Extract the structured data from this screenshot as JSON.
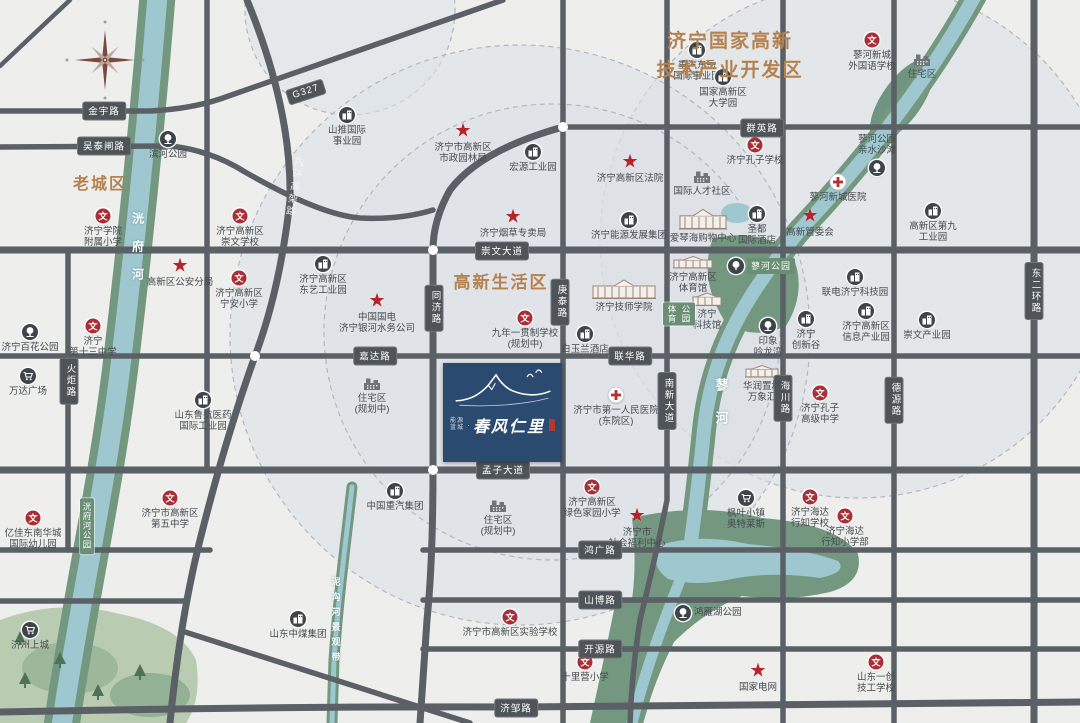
{
  "map": {
    "title": "济宁国家高新\n技术产业开发区",
    "area_labels": [
      {
        "text": "老城区",
        "x": 100,
        "y": 170,
        "size": 16
      },
      {
        "text": "高新生活区",
        "x": 501,
        "y": 268,
        "size": 17
      }
    ],
    "road_badges": [
      {
        "text": "金宇路",
        "x": 104,
        "y": 111,
        "orient": "h"
      },
      {
        "text": "吴泰闸路",
        "x": 104,
        "y": 146,
        "orient": "h"
      },
      {
        "text": "崇文大道",
        "x": 502,
        "y": 251,
        "orient": "h"
      },
      {
        "text": "群英路",
        "x": 762,
        "y": 128,
        "orient": "h"
      },
      {
        "text": "嘉达路",
        "x": 375,
        "y": 356,
        "orient": "h"
      },
      {
        "text": "联华路",
        "x": 630,
        "y": 356,
        "orient": "h"
      },
      {
        "text": "孟子大道",
        "x": 503,
        "y": 470,
        "orient": "h"
      },
      {
        "text": "鸿广路",
        "x": 600,
        "y": 550,
        "orient": "h"
      },
      {
        "text": "山博路",
        "x": 600,
        "y": 600,
        "orient": "h"
      },
      {
        "text": "开源路",
        "x": 600,
        "y": 649,
        "orient": "h"
      },
      {
        "text": "济邹路",
        "x": 516,
        "y": 708,
        "orient": "h"
      },
      {
        "text": "G327",
        "x": 306,
        "y": 92,
        "orient": "h",
        "rot": -18
      },
      {
        "text": "同济路",
        "x": 434,
        "y": 308,
        "orient": "v"
      },
      {
        "text": "庚泰路",
        "x": 560,
        "y": 302,
        "orient": "v"
      },
      {
        "text": "南新大道",
        "x": 667,
        "y": 401,
        "orient": "v"
      },
      {
        "text": "海川路",
        "x": 783,
        "y": 398,
        "orient": "v"
      },
      {
        "text": "德源路",
        "x": 894,
        "y": 400,
        "orient": "v"
      },
      {
        "text": "东二环路",
        "x": 1034,
        "y": 291,
        "orient": "v"
      },
      {
        "text": "火炬路",
        "x": 69,
        "y": 381,
        "orient": "v"
      }
    ],
    "road_names_on_road": [
      {
        "text": "内环高架路",
        "x": 293,
        "y": 156,
        "rot": 10
      }
    ],
    "green_badges": [
      {
        "kind": "cols",
        "cols": [
          "体育",
          "公园"
        ],
        "x": 679,
        "y": 314
      },
      {
        "kind": "pill",
        "text": "蓼河公园",
        "x": 728,
        "y": 266
      },
      {
        "kind": "vcol",
        "text": "洸府河公园",
        "x": 87,
        "y": 526
      }
    ],
    "river_labels": [
      {
        "text": "洸府河",
        "x": 138,
        "y": 212,
        "size": 12,
        "ls": 16
      },
      {
        "text": "蓼河",
        "x": 721,
        "y": 378,
        "size": 13,
        "ls": 20
      },
      {
        "text": "泥沟河景观带",
        "x": 336,
        "y": 577,
        "size": 9,
        "ls": 6
      }
    ],
    "markers": [
      {
        "type": "wen",
        "x": 103,
        "y": 216,
        "label": "济宁学院\n附属小学"
      },
      {
        "type": "wen",
        "x": 240,
        "y": 216,
        "label": "济宁高新区\n崇文学校"
      },
      {
        "type": "wen",
        "x": 239,
        "y": 278,
        "label": "济宁高新区\n宁安小学"
      },
      {
        "type": "wen",
        "x": 93,
        "y": 326,
        "label": "济宁\n第十三中学"
      },
      {
        "type": "wen",
        "x": 33,
        "y": 518,
        "label": "亿佳东南华城\n国际幼儿园"
      },
      {
        "type": "wen",
        "x": 170,
        "y": 498,
        "label": "济宁市高新区\n第五中学"
      },
      {
        "type": "wen",
        "x": 525,
        "y": 318,
        "label": "九年一贯制学校\n(规划中)"
      },
      {
        "type": "wen",
        "x": 872,
        "y": 40,
        "label": "蓼河新城\n外国语学校"
      },
      {
        "type": "wen",
        "x": 755,
        "y": 145,
        "label": "济宁孔子学校"
      },
      {
        "type": "wen",
        "x": 820,
        "y": 393,
        "label": "济宁孔子\n高级中学"
      },
      {
        "type": "wen",
        "x": 592,
        "y": 487,
        "label": "济宁高新区\n绿色家园小学"
      },
      {
        "type": "wen",
        "x": 510,
        "y": 617,
        "label": "济宁市高新区实验学校"
      },
      {
        "type": "wen",
        "x": 585,
        "y": 662,
        "label": "十里营小学"
      },
      {
        "type": "wen",
        "x": 810,
        "y": 497,
        "label": "济宁海达\n行知学校"
      },
      {
        "type": "wen",
        "x": 845,
        "y": 516,
        "label": "济宁海达\n行知小学部"
      },
      {
        "type": "wen",
        "x": 876,
        "y": 662,
        "label": "山东一创\n技工学校"
      },
      {
        "type": "star",
        "x": 463,
        "y": 131,
        "label": "济宁市高新区\n市政园林局"
      },
      {
        "type": "star",
        "x": 630,
        "y": 162,
        "label": "济宁高新区法院"
      },
      {
        "type": "star",
        "x": 513,
        "y": 217,
        "label": "济宁烟草专卖局"
      },
      {
        "type": "star",
        "x": 180,
        "y": 266,
        "label": "高新区公安分局"
      },
      {
        "type": "star",
        "x": 377,
        "y": 301,
        "label": "中国国电\n济宁银河水务公司"
      },
      {
        "type": "star",
        "x": 810,
        "y": 216,
        "label": "高新管委会"
      },
      {
        "type": "star",
        "x": 637,
        "y": 516,
        "label": "济宁市\n社会福利中心"
      },
      {
        "type": "star",
        "x": 758,
        "y": 671,
        "label": "国家电网"
      },
      {
        "type": "building",
        "x": 347,
        "y": 115,
        "label": "山推国际\n事业园"
      },
      {
        "type": "building",
        "x": 697,
        "y": 50,
        "label": "重汽东岳\n国际事业园"
      },
      {
        "type": "building",
        "x": 723,
        "y": 77,
        "label": "国家高新区\n大学园"
      },
      {
        "type": "building",
        "x": 533,
        "y": 152,
        "label": "宏源工业园"
      },
      {
        "type": "building",
        "x": 629,
        "y": 220,
        "label": "济宁能源发展集团"
      },
      {
        "type": "building",
        "x": 757,
        "y": 214,
        "label": "圣都\n国际酒店"
      },
      {
        "type": "building",
        "x": 585,
        "y": 334,
        "label": "白玉兰酒店"
      },
      {
        "type": "building",
        "x": 323,
        "y": 264,
        "label": "济宁高新区\n东艺工业园"
      },
      {
        "type": "building",
        "x": 855,
        "y": 277,
        "label": "联电济宁科技园"
      },
      {
        "type": "building",
        "x": 806,
        "y": 319,
        "label": "济宁\n创新谷"
      },
      {
        "type": "building",
        "x": 866,
        "y": 311,
        "label": "济宁高新区\n信息产业园"
      },
      {
        "type": "building",
        "x": 927,
        "y": 320,
        "label": "崇文产业园"
      },
      {
        "type": "building",
        "x": 933,
        "y": 211,
        "label": "高新区第九\n工业园"
      },
      {
        "type": "building",
        "x": 203,
        "y": 400,
        "label": "山东鲁抗医药\n国际工业园"
      },
      {
        "type": "building",
        "x": 395,
        "y": 491,
        "label": "中国重汽集团"
      },
      {
        "type": "building",
        "x": 298,
        "y": 619,
        "label": "山东中煤集团"
      },
      {
        "type": "park",
        "x": 168,
        "y": 139,
        "label": "滨河公园"
      },
      {
        "type": "park",
        "x": 30,
        "y": 332,
        "label": "济宁百花公园"
      },
      {
        "type": "park",
        "x": 877,
        "y": 168,
        "label": "蓼河公园\n亲水沙滩",
        "lpos": "t"
      },
      {
        "type": "park",
        "x": 768,
        "y": 326,
        "label": "印象\n吟龙湾"
      },
      {
        "type": "park",
        "x": 683,
        "y": 613,
        "label": "鸿雁湖公园",
        "lpos": "r"
      },
      {
        "type": "cart",
        "x": 28,
        "y": 376,
        "label": "万达广场"
      },
      {
        "type": "cart",
        "x": 30,
        "y": 630,
        "label": "济州上城"
      },
      {
        "type": "cart",
        "x": 746,
        "y": 498,
        "label": "枫叶小镇\n奥特莱斯"
      },
      {
        "type": "hospital",
        "x": 616,
        "y": 395,
        "label": "济宁市第一人民医院\n(东院区)"
      },
      {
        "type": "hospital",
        "x": 838,
        "y": 182,
        "label": "蓼河新城医院"
      },
      {
        "type": "residence",
        "x": 372,
        "y": 384,
        "label": "住宅区\n(规划中)"
      },
      {
        "type": "residence",
        "x": 498,
        "y": 506,
        "label": "住宅区\n(规划中)"
      },
      {
        "type": "residence",
        "x": 922,
        "y": 60,
        "label": "住宅区"
      },
      {
        "type": "residence",
        "x": 702,
        "y": 177,
        "label": "国际人才社区"
      },
      {
        "type": "sketch",
        "x": 624,
        "y": 289,
        "w": 64,
        "h": 20,
        "label": "济宁技师学院"
      },
      {
        "type": "sketch",
        "x": 703,
        "y": 219,
        "w": 48,
        "h": 21,
        "label": "爱琴海购物中心"
      },
      {
        "type": "sketch",
        "x": 693,
        "y": 262,
        "w": 40,
        "h": 13,
        "label": "济宁高新区\n体育馆"
      },
      {
        "type": "sketch",
        "x": 707,
        "y": 299,
        "w": 30,
        "h": 14,
        "label": "济宁\n科技馆"
      },
      {
        "type": "sketch",
        "x": 762,
        "y": 371,
        "w": 34,
        "h": 13,
        "label": "华润置地\n万象汇"
      }
    ],
    "project": {
      "brand_small": "能源\n蓝城",
      "separator": "·",
      "name": "春风仁里"
    },
    "colors": {
      "background": "#eeeeec",
      "accent_orange": "#b5824f",
      "road": "#5a6065",
      "badge": "#4e5458",
      "river_water": "#9ec7cf",
      "river_bank": "#73977f",
      "school_red": "#a62f38",
      "star_red": "#b5242c",
      "marker_dark": "#3e444a",
      "project_navy": "#2b4a70",
      "zone_fill": "#dce1e7",
      "green_badge": "#6b8f74"
    }
  }
}
